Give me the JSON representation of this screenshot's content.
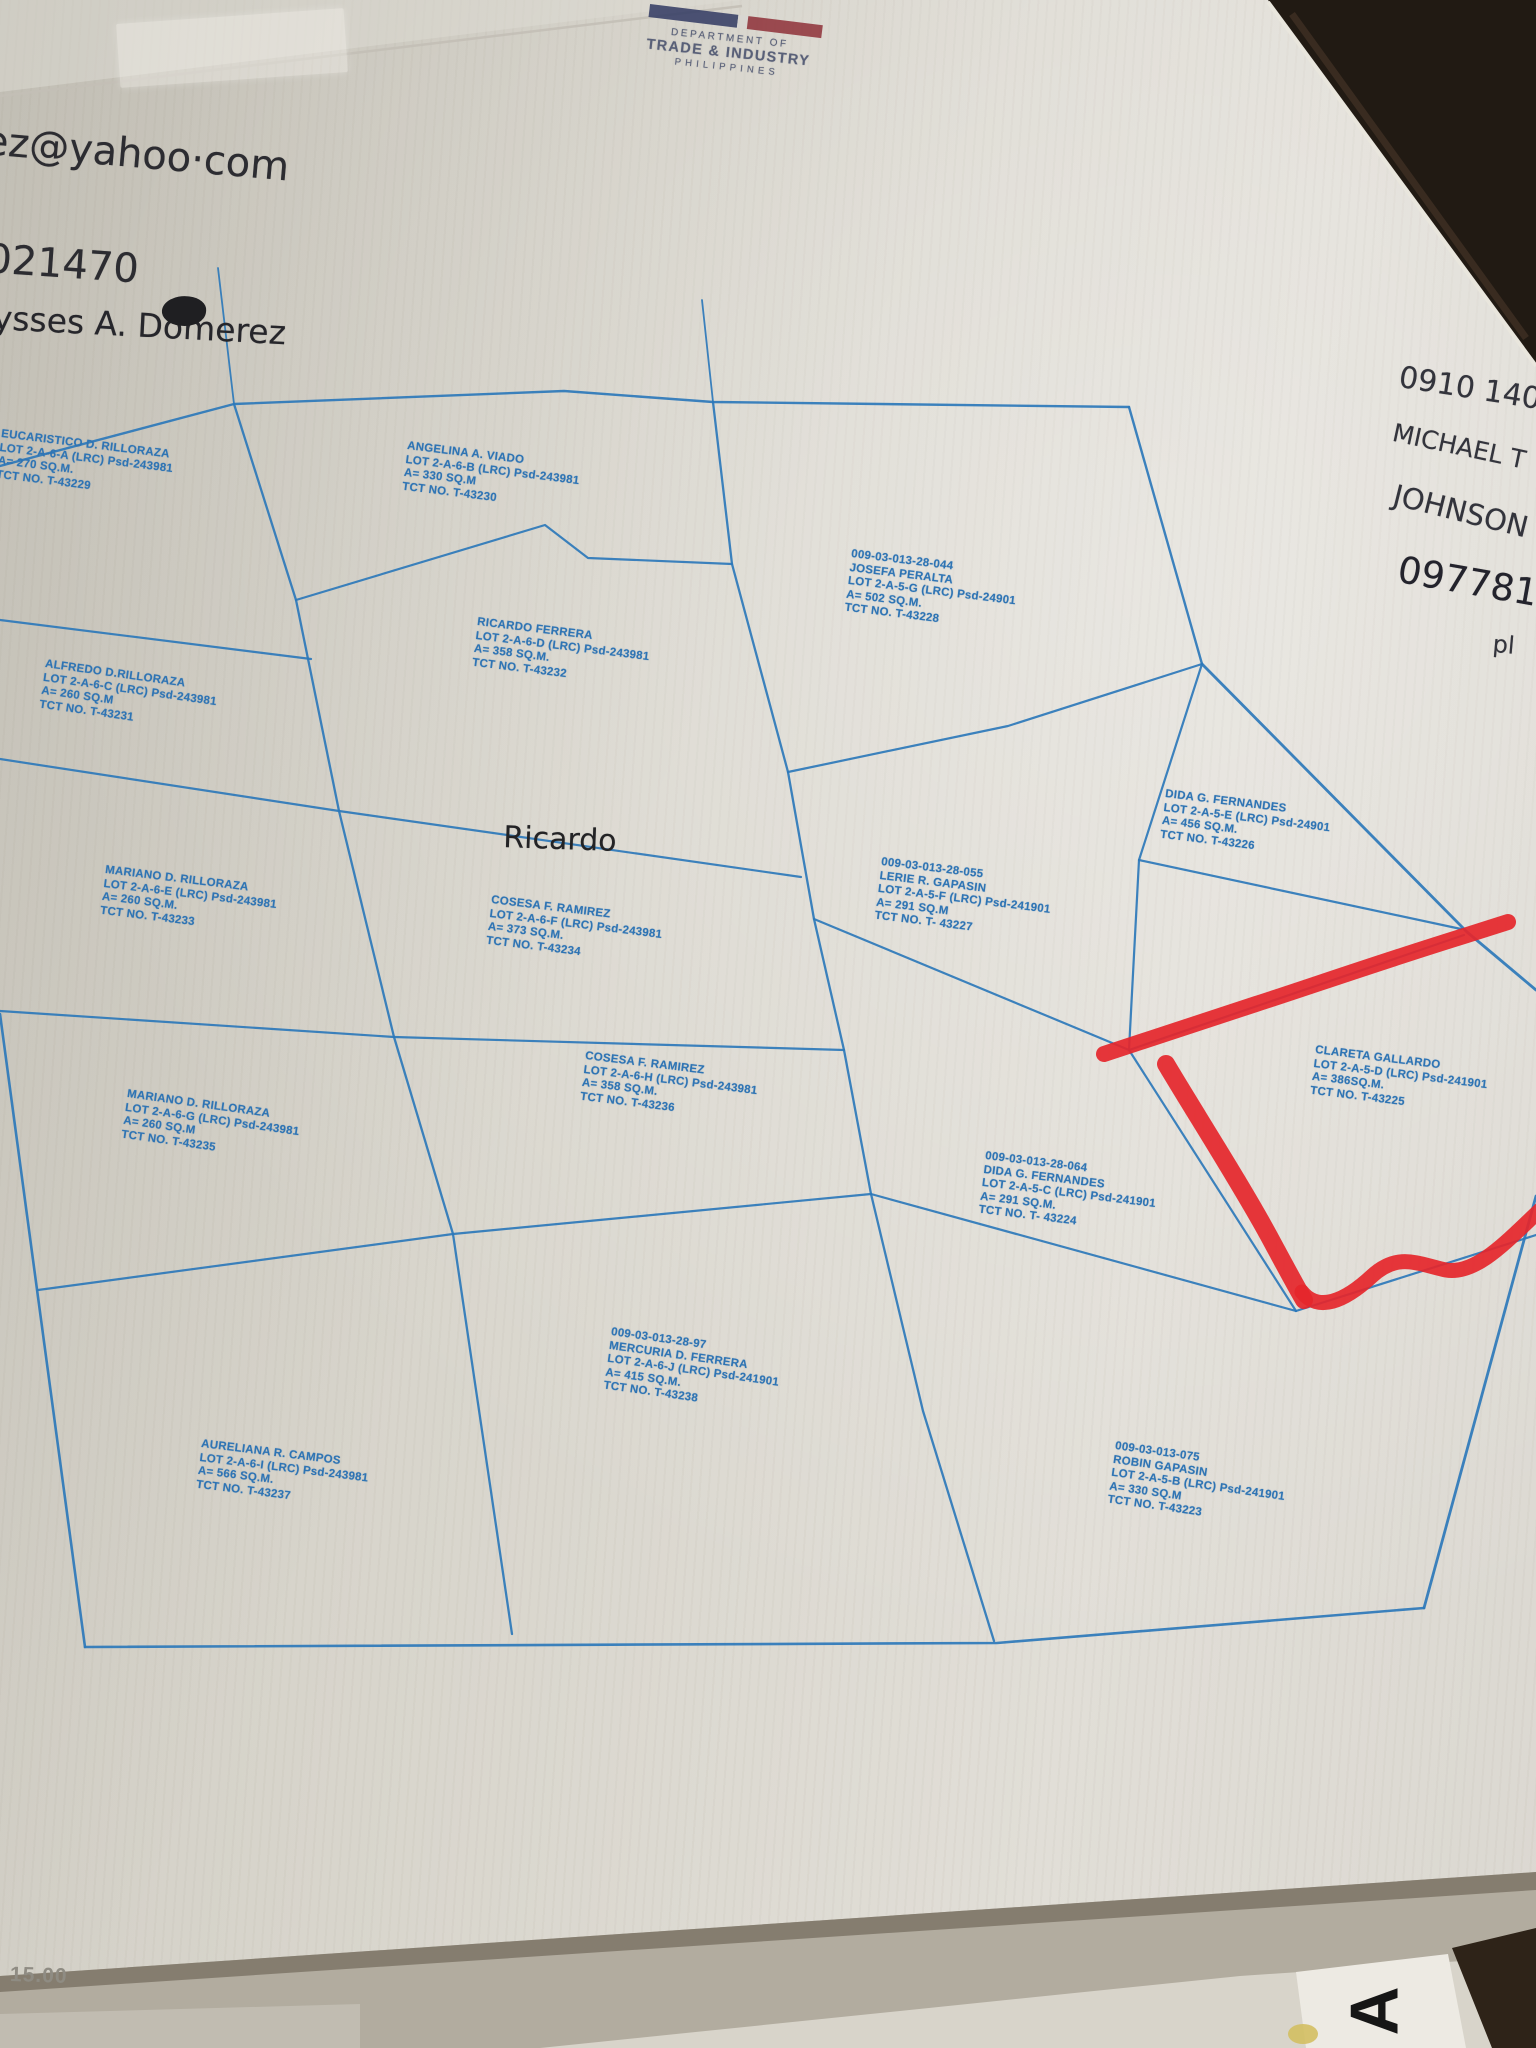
{
  "stamp": {
    "department": "DEPARTMENT OF",
    "agency": "TRADE & INDUSTRY",
    "country": "PHILIPPINES"
  },
  "handwriting": {
    "notes": [
      {
        "id": "email",
        "text": "ez@yahoo·com",
        "x": -14,
        "y": 118,
        "size": 40,
        "rot": 5,
        "color": "#2c2c31"
      },
      {
        "id": "number-top-left",
        "text": "021470",
        "x": -12,
        "y": 236,
        "size": 40,
        "rot": 4,
        "color": "#2c2c31"
      },
      {
        "id": "name-top-left",
        "text": "ysses A. Domerez",
        "x": -6,
        "y": 298,
        "size": 33,
        "rot": 3,
        "color": "#26262b"
      },
      {
        "id": "number-right-1",
        "text": "0910 140",
        "x": 1402,
        "y": 360,
        "size": 30,
        "rot": 9,
        "color": "#33343c"
      },
      {
        "id": "name-right-first",
        "text": "MICHAEL T",
        "x": 1396,
        "y": 418,
        "size": 25,
        "rot": 12,
        "color": "#33343c"
      },
      {
        "id": "name-right-last",
        "text": "JOHNSON",
        "x": 1398,
        "y": 478,
        "size": 29,
        "rot": 14,
        "color": "#33343c"
      },
      {
        "id": "number-right-2",
        "text": "097781",
        "x": 1402,
        "y": 548,
        "size": 37,
        "rot": 10,
        "color": "#23232c"
      },
      {
        "id": "partial-right",
        "text": "pl",
        "x": 1494,
        "y": 630,
        "size": 24,
        "rot": 5,
        "color": "#33343c"
      },
      {
        "id": "map-note-ricardo",
        "text": "Ricardo",
        "x": 504,
        "y": 820,
        "size": 30,
        "rot": 2,
        "color": "#232325"
      }
    ]
  },
  "lots": [
    {
      "id": "eucaristico",
      "lines": [
        "EUCARISTICO D. RILLORAZA",
        "LOT 2-A-6-A (LRC) Psd-243981",
        "A= 270 SQ.M.",
        "TCT NO. T-43229"
      ],
      "x": 2,
      "y": 428,
      "rot": 7
    },
    {
      "id": "angelina",
      "lines": [
        "ANGELINA A. VIADO",
        "LOT 2-A-6-B (LRC) Psd-243981",
        "A= 330 SQ.M",
        "TCT NO. T-43230"
      ],
      "x": 408,
      "y": 440,
      "rot": 7
    },
    {
      "id": "josefa",
      "lines": [
        "009-03-013-28-044",
        "JOSEFA PERALTA",
        "LOT 2-A-5-G (LRC) Psd-24901",
        "A= 502 SQ.M.",
        "TCT NO. T-43228"
      ],
      "x": 852,
      "y": 548,
      "rot": 7
    },
    {
      "id": "ricardo-ferrera",
      "lines": [
        "RICARDO FERRERA",
        "LOT 2-A-6-D (LRC) Psd-243981",
        "A= 358 SQ.M.",
        "TCT NO. T-43232"
      ],
      "x": 478,
      "y": 616,
      "rot": 7
    },
    {
      "id": "alfredo",
      "lines": [
        "ALFREDO D.RILLORAZA",
        "LOT 2-A-6-C (LRC) Psd-243981",
        "A= 260 SQ.M",
        "TCT NO. T-43231"
      ],
      "x": 46,
      "y": 658,
      "rot": 8
    },
    {
      "id": "dida-fernandes-e",
      "lines": [
        "DIDA G. FERNANDES",
        "LOT 2-A-5-E (LRC) Psd-24901",
        "A= 456 SQ.M.",
        "TCT NO. T-43226"
      ],
      "x": 1166,
      "y": 788,
      "rot": 7
    },
    {
      "id": "lerie-gapasin",
      "lines": [
        "009-03-013-28-055",
        "LERIE R. GAPASIN",
        "LOT 2-A-5-F (LRC) Psd-241901",
        "A= 291 SQ.M",
        "TCT NO. T- 43227"
      ],
      "x": 882,
      "y": 856,
      "rot": 7
    },
    {
      "id": "mariano-e",
      "lines": [
        "MARIANO D. RILLORAZA",
        "LOT 2-A-6-E (LRC) Psd-243981",
        "A= 260 SQ.M.",
        "TCT NO. T-43233"
      ],
      "x": 106,
      "y": 864,
      "rot": 7
    },
    {
      "id": "cosesa-f",
      "lines": [
        "COSESA F. RAMIREZ",
        "LOT 2-A-6-F (LRC) Psd-243981",
        "A= 373 SQ.M.",
        "TCT NO. T-43234"
      ],
      "x": 492,
      "y": 894,
      "rot": 7
    },
    {
      "id": "cosesa-h",
      "lines": [
        "COSESA F. RAMIREZ",
        "LOT 2-A-6-H (LRC) Psd-243981",
        "A= 358 SQ.M.",
        "TCT NO. T-43236"
      ],
      "x": 586,
      "y": 1050,
      "rot": 7
    },
    {
      "id": "clareta-gallardo",
      "lines": [
        "CLARETA GALLARDO",
        "LOT 2-A-5-D (LRC) Psd-241901",
        "A= 386SQ.M.",
        "TCT NO. T-43225"
      ],
      "x": 1316,
      "y": 1044,
      "rot": 7
    },
    {
      "id": "mariano-g",
      "lines": [
        "MARIANO D. RILLORAZA",
        "LOT 2-A-6-G (LRC) Psd-243981",
        "A= 260 SQ.M",
        "TCT NO. T-43235"
      ],
      "x": 128,
      "y": 1088,
      "rot": 8
    },
    {
      "id": "dida-fernandes-c",
      "lines": [
        "009-03-013-28-064",
        "DIDA G. FERNANDES",
        "LOT 2-A-5-C (LRC) Psd-241901",
        "A= 291 SQ.M.",
        "TCT NO. T- 43224"
      ],
      "x": 986,
      "y": 1150,
      "rot": 7
    },
    {
      "id": "mercuria-ferrera",
      "lines": [
        "009-03-013-28-97",
        "MERCURIA D. FERRERA",
        "LOT 2-A-6-J (LRC) Psd-241901",
        "A= 415 SQ.M.",
        "TCT NO. T-43238"
      ],
      "x": 612,
      "y": 1326,
      "rot": 8
    },
    {
      "id": "aureliana-campos",
      "lines": [
        "AURELIANA R. CAMPOS",
        "LOT 2-A-6-I (LRC) Psd-243981",
        "A= 566 SQ.M.",
        "TCT NO. T-43237"
      ],
      "x": 202,
      "y": 1438,
      "rot": 7
    },
    {
      "id": "robin-gapasin",
      "lines": [
        "009-03-013-075",
        "ROBIN GAPASIN",
        "LOT 2-A-5-B (LRC) Psd-241901",
        "A= 330 SQ.M",
        "TCT NO. T-43223"
      ],
      "x": 1116,
      "y": 1440,
      "rot": 8
    }
  ],
  "plan": {
    "stroke_color": "#2d78ba",
    "lines": [
      {
        "id": "top-edge",
        "pts": [
          [
            0,
            466
          ],
          [
            234,
            404
          ],
          [
            564,
            391
          ],
          [
            713,
            402
          ],
          [
            1129,
            407
          ]
        ],
        "w": 2.4
      },
      {
        "id": "top-right-slant",
        "pts": [
          [
            1129,
            407
          ],
          [
            1202,
            664
          ]
        ],
        "w": 2.4
      },
      {
        "id": "right-upper-edge",
        "pts": [
          [
            1202,
            664
          ],
          [
            1467,
            932
          ],
          [
            1536,
            990
          ]
        ],
        "w": 2.8
      },
      {
        "id": "right-lower-edge",
        "pts": [
          [
            1536,
            1196
          ],
          [
            1424,
            1608
          ]
        ],
        "w": 2.8
      },
      {
        "id": "bottom-edge",
        "pts": [
          [
            1424,
            1608
          ],
          [
            997,
            1643
          ],
          [
            85,
            1647
          ]
        ],
        "w": 2.6
      },
      {
        "id": "left-edge",
        "pts": [
          [
            85,
            1647
          ],
          [
            0,
            1014
          ]
        ],
        "w": 2.6
      },
      {
        "id": "column-line-west",
        "pts": [
          [
            234,
            404
          ],
          [
            296,
            600
          ],
          [
            339,
            811
          ],
          [
            394,
            1037
          ],
          [
            453,
            1234
          ],
          [
            512,
            1634
          ]
        ],
        "w": 2.3
      },
      {
        "id": "column-line-mid",
        "pts": [
          [
            713,
            402
          ],
          [
            732,
            564
          ],
          [
            788,
            772
          ],
          [
            814,
            919
          ],
          [
            844,
            1050
          ],
          [
            871,
            1194
          ],
          [
            923,
            1411
          ],
          [
            994,
            1641
          ]
        ],
        "w": 2.3
      },
      {
        "id": "stub-west",
        "pts": [
          [
            218,
            268
          ],
          [
            234,
            404
          ]
        ],
        "w": 1.8
      },
      {
        "id": "stub-mid",
        "pts": [
          [
            702,
            300
          ],
          [
            713,
            402
          ]
        ],
        "w": 1.8
      },
      {
        "id": "row-eucaristico-alfredo",
        "pts": [
          [
            0,
            620
          ],
          [
            311,
            659
          ]
        ],
        "w": 2.2
      },
      {
        "id": "angelina-bottom",
        "pts": [
          [
            296,
            600
          ],
          [
            545,
            525
          ],
          [
            588,
            558
          ],
          [
            732,
            564
          ]
        ],
        "w": 2.2
      },
      {
        "id": "row-alfredo-mariano",
        "pts": [
          [
            0,
            759
          ],
          [
            339,
            811
          ],
          [
            801,
            877
          ]
        ],
        "w": 2.2
      },
      {
        "id": "josefa-bottom",
        "pts": [
          [
            788,
            772
          ],
          [
            1008,
            726
          ],
          [
            1202,
            664
          ]
        ],
        "w": 2.2
      },
      {
        "id": "row-mariano-marianog-left",
        "pts": [
          [
            0,
            1011
          ],
          [
            394,
            1037
          ]
        ],
        "w": 2.2
      },
      {
        "id": "cosesa-f-bottom",
        "pts": [
          [
            394,
            1037
          ],
          [
            844,
            1050
          ]
        ],
        "w": 2.2
      },
      {
        "id": "lerie-dida064-split",
        "pts": [
          [
            814,
            919
          ],
          [
            1129,
            1050
          ]
        ],
        "w": 2.2
      },
      {
        "id": "column-line-east",
        "pts": [
          [
            1202,
            664
          ],
          [
            1139,
            860
          ],
          [
            1129,
            1050
          ]
        ],
        "w": 2.2
      },
      {
        "id": "didatop-bottom",
        "pts": [
          [
            1139,
            860
          ],
          [
            1461,
            929
          ]
        ],
        "w": 2.2
      },
      {
        "id": "clareta-top",
        "pts": [
          [
            1129,
            1050
          ],
          [
            1464,
            935
          ]
        ],
        "w": 2.2
      },
      {
        "id": "clareta-left",
        "pts": [
          [
            1129,
            1050
          ],
          [
            1296,
            1311
          ]
        ],
        "w": 2.2
      },
      {
        "id": "clareta-bottom",
        "pts": [
          [
            1296,
            1311
          ],
          [
            1536,
            1235
          ]
        ],
        "w": 2.2
      },
      {
        "id": "robin-top",
        "pts": [
          [
            871,
            1194
          ],
          [
            1296,
            1311
          ]
        ],
        "w": 2.2
      },
      {
        "id": "row-marianog-aureliana",
        "pts": [
          [
            38,
            1290
          ],
          [
            453,
            1234
          ]
        ],
        "w": 2.2
      },
      {
        "id": "cosesa-h-bottom",
        "pts": [
          [
            453,
            1234
          ],
          [
            871,
            1194
          ]
        ],
        "w": 2.2
      }
    ],
    "red_annotation": {
      "color": "#e5262b",
      "paths": [
        {
          "id": "red-top-stroke",
          "d": "M1104,1054 L1256,1004 C1300,990 1380,962 1464,936 L1508,922",
          "w": 16
        },
        {
          "id": "red-left-stroke",
          "d": "M1166,1064 C1192,1108 1242,1186 1270,1238 C1284,1264 1298,1290 1304,1300",
          "w": 18
        },
        {
          "id": "red-bottom-stroke",
          "d": "M1302,1292 C1318,1312 1344,1302 1372,1276 C1398,1252 1418,1264 1446,1270 C1476,1275 1506,1242 1540,1210",
          "w": 15
        }
      ]
    }
  },
  "footer": {
    "scale_text": "15.00",
    "letter": "A"
  }
}
